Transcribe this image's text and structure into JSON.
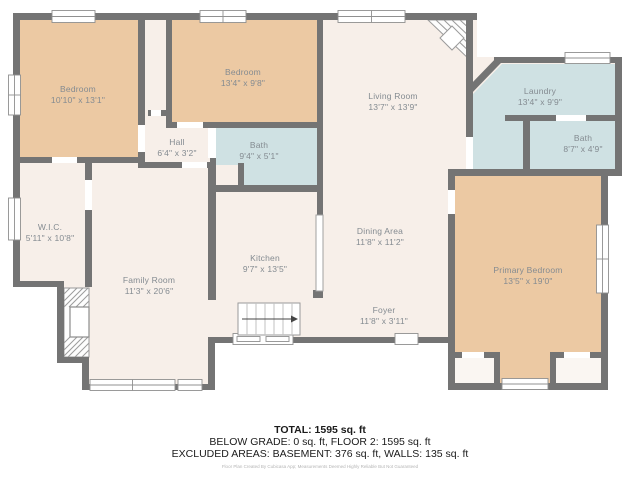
{
  "colors": {
    "wall": "#747474",
    "bedroom_fill": "#ecc9a3",
    "floor_fill": "#f7efe9",
    "wet_room_fill": "#cfe1e3",
    "label_text": "#848b91",
    "footer_text": "#1b1b1b"
  },
  "rooms": {
    "bedroom_1": {
      "name": "Bedroom",
      "dims": "10'10\" x 13'1\""
    },
    "bedroom_2": {
      "name": "Bedroom",
      "dims": "13'4\" x 9'8\""
    },
    "living_room": {
      "name": "Living Room",
      "dims": "13'7\" x 13'9\""
    },
    "laundry": {
      "name": "Laundry",
      "dims": "13'4\" x 9'9\""
    },
    "bath_right": {
      "name": "Bath",
      "dims": "8'7\" x 4'9\""
    },
    "hall": {
      "name": "Hall",
      "dims": "6'4\" x 3'2\""
    },
    "bath_top": {
      "name": "Bath",
      "dims": "9'4\" x 5'1\""
    },
    "wic": {
      "name": "W.I.C.",
      "dims": "5'11\" x 10'8\""
    },
    "family_room": {
      "name": "Family Room",
      "dims": "11'3\" x 20'6\""
    },
    "kitchen": {
      "name": "Kitchen",
      "dims": "9'7\" x 13'5\""
    },
    "dining_area": {
      "name": "Dining Area",
      "dims": "11'8\" x 11'2\""
    },
    "foyer": {
      "name": "Foyer",
      "dims": "11'8\" x 3'11\""
    },
    "primary_bedroom": {
      "name": "Primary Bedroom",
      "dims": "13'5\" x 19'0\""
    }
  },
  "footer": {
    "total": "TOTAL: 1595 sq. ft",
    "below_grade": "BELOW GRADE: 0 sq. ft, FLOOR 2: 1595 sq. ft",
    "excluded": "EXCLUDED AREAS: BASEMENT: 376 sq. ft, WALLS: 135 sq. ft",
    "disclaimer": "Floor Plan Created By Cubicasa App; Measurements Deemed Highly Reliable But Not Guaranteed"
  }
}
